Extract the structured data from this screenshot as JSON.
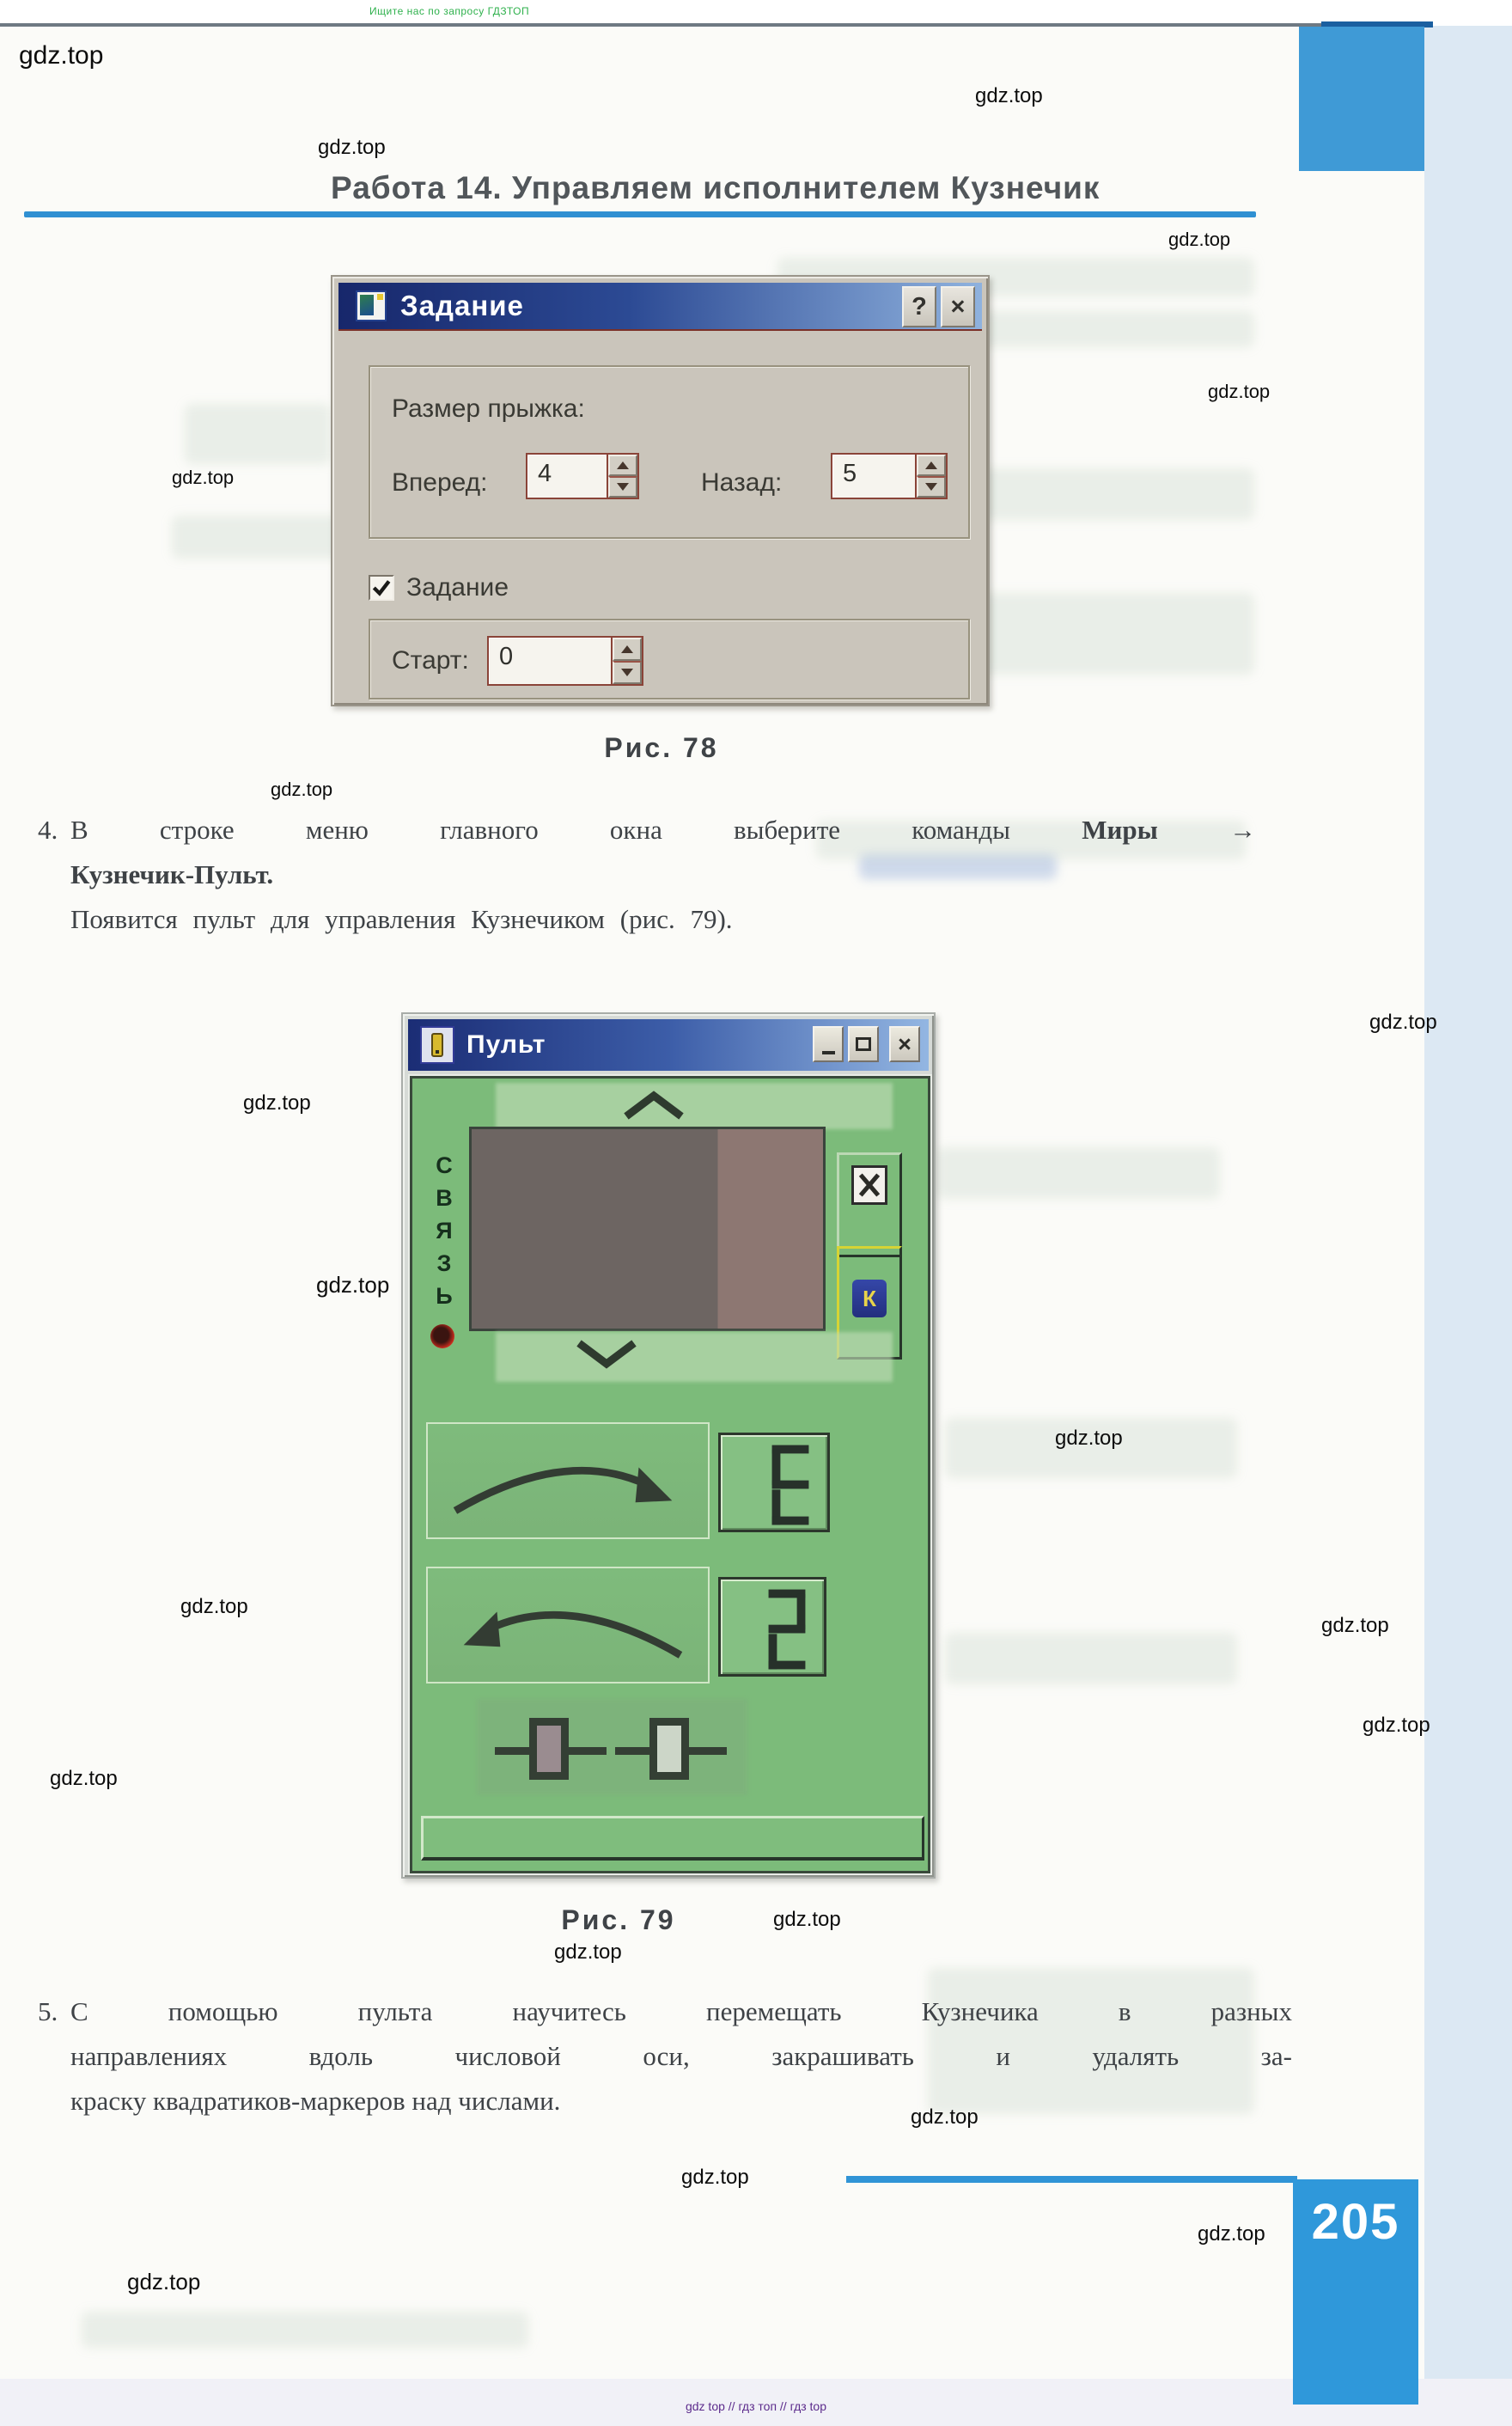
{
  "page": {
    "header_note": "Ищите нас по запросу ГДЗТОП",
    "watermark": "gdz.top",
    "title": "Работа 14. Управляем исполнителем Кузнечик",
    "page_number": "205",
    "footer": "gdz top  //  гдз топ  //  гдз top"
  },
  "figure78": {
    "caption": "Рис. 78",
    "dialog": {
      "title": "Задание",
      "icon": "task-window-icon",
      "help_button": "?",
      "close_button": "×",
      "jump_size_group_label": "Размер прыжка:",
      "forward": {
        "label": "Вперед:",
        "value": "4"
      },
      "back": {
        "label": "Назад:",
        "value": "5"
      },
      "task_checkbox": {
        "label": "Задание",
        "checked": true
      },
      "start": {
        "label": "Старт:",
        "value": "0"
      }
    }
  },
  "step4": {
    "number": "4.",
    "line1_normal": "В строке меню главного окна выберите команды",
    "line1_bold": "Миры",
    "line1_arrow": "→",
    "line2_bold": "Кузнечик-Пульт.",
    "line3": "Появится пульт для управления Кузнечиком (рис. 79)."
  },
  "figure79": {
    "caption": "Рис. 79",
    "window": {
      "title": "Пульт",
      "icons": {
        "minimize": "–",
        "maximize": "□",
        "close": "×"
      },
      "link_label": "СВЯЗЬ",
      "link_letters": [
        "С",
        "В",
        "Я",
        "З",
        "Ь"
      ],
      "x_key_icon": "✕",
      "k_key": "К",
      "forward_display": "3",
      "back_display": "2",
      "forward_display_note": "seven-segment, mirrored 3",
      "marker_filled": "закрашенный маркер",
      "marker_empty": "пустой маркер"
    }
  },
  "step5": {
    "number": "5.",
    "line1": "С помощью пульта научитесь перемещать Кузнечика в разных",
    "line2": "направлениях вдоль числовой оси, закрашивать и удалять за-",
    "line3": "краску квадратиков-маркеров над числами."
  },
  "colors": {
    "accent_blue": "#2f90d2",
    "page_number_blue": "#2f98da",
    "pult_green": "#7cbb7a",
    "titlebar_navy": "#1b2d75",
    "header_green": "#2fb14d",
    "footer_purple": "#5c2b8c",
    "spin_border_maroon": "#8a4438"
  }
}
